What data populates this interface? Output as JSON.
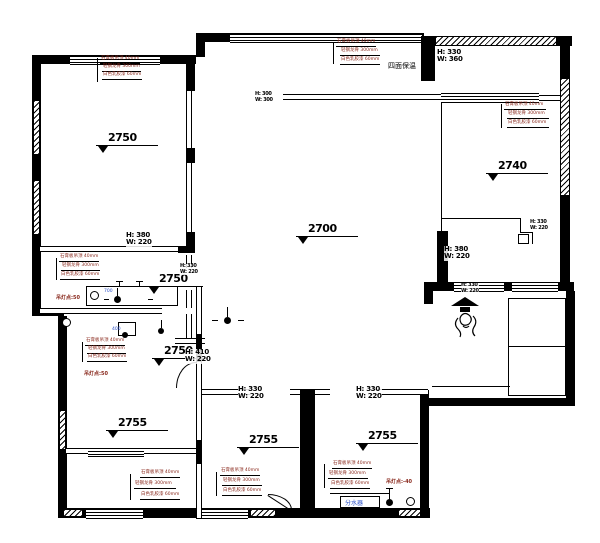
{
  "annotations": {
    "levels": [
      {
        "label": "2750",
        "room": "top-left-room"
      },
      {
        "label": "2700",
        "room": "living-room"
      },
      {
        "label": "2740",
        "room": "top-right-room"
      },
      {
        "label": "2750",
        "room": "bath-upper"
      },
      {
        "label": "2750",
        "room": "bath-lower"
      },
      {
        "label": "2755",
        "room": "bottom-left-room"
      },
      {
        "label": "2755",
        "room": "bottom-middle-room"
      },
      {
        "label": "2755",
        "room": "bottom-right-room"
      }
    ],
    "beams": [
      {
        "line1": "H: 380",
        "line2": "W: 220"
      },
      {
        "line1": "H: 380",
        "line2": "W: 220"
      },
      {
        "line1": "H: 330",
        "line2": "W: 360"
      },
      {
        "line1": "H: 410",
        "line2": "W: 220"
      },
      {
        "line1": "H: 330",
        "line2": "W: 220"
      },
      {
        "line1": "H: 330",
        "line2": "W: 220"
      },
      {
        "line1": "H: 300",
        "line2": "W: 300"
      },
      {
        "line1": "H: 330",
        "line2": "W: 220"
      },
      {
        "line1": "H: 330",
        "line2": "W: 220"
      },
      {
        "line1": "H: 330",
        "line2": "W: 220"
      }
    ],
    "callout_lines": {
      "l1": "石膏板吊顶 40mm",
      "l2": "轻钢龙骨 300mm",
      "l3": "白色乳胶漆 60mm"
    },
    "notes": {
      "insulation": "四面保温",
      "manifold": "分水器",
      "lamp_point_a": "吊灯点:50",
      "lamp_point_b": "吊灯点:50",
      "lamp_point_c": "吊灯点:-40",
      "dim_blue_700": "700",
      "dim_blue_400": "400"
    }
  }
}
